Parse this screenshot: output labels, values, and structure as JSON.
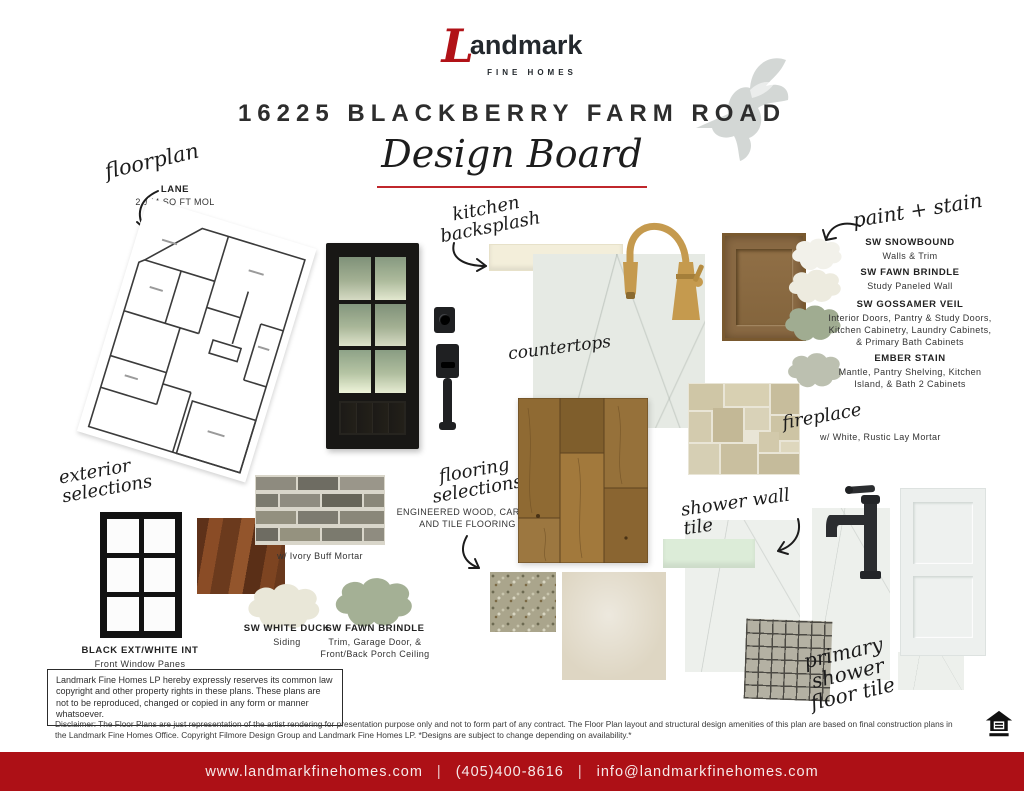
{
  "accent_red": "#b11217",
  "header": {
    "brand_initial": "L",
    "brand_rest": "andmark",
    "brand_sub": "FINE HOMES",
    "title": "16225 BLACKBERRY FARM ROAD",
    "subtitle": "Design Board"
  },
  "floorplan": {
    "label": "floorplan",
    "plan_name": "LANE",
    "plan_size": "2,144 SQ FT MOL"
  },
  "kitchen_backsplash": {
    "label": "kitchen backsplash"
  },
  "countertops": {
    "label": "countertops"
  },
  "paint_stain": {
    "label": "paint + stain",
    "items": [
      {
        "name": "SW SNOWBOUND",
        "desc": "Walls & Trim",
        "color": "#f2f1ea"
      },
      {
        "name": "SW FAWN BRINDLE",
        "desc": "Study Paneled Wall",
        "color": "#edebdf"
      },
      {
        "name": "SW GOSSAMER VEIL",
        "desc": "Interior Doors, Pantry & Study Doors, Kitchen Cabinetry, Laundry Cabinets, & Primary Bath Cabinets",
        "color": "#a0ac91"
      },
      {
        "name": "EMBER STAIN",
        "desc": "Mantle, Pantry Shelving, Kitchen Island, & Bath 2 Cabinets",
        "color": "#bcc0b0"
      }
    ]
  },
  "fireplace": {
    "label": "fireplace",
    "desc": "w/ White, Rustic Lay Mortar"
  },
  "exterior": {
    "label": "exterior selections",
    "window_name": "BLACK EXT/WHITE INT",
    "window_desc": "Front Window Panes",
    "brick_desc": "w/ Ivory Buff Mortar",
    "paints": [
      {
        "name": "SW WHITE DUCK",
        "desc": "Siding",
        "color": "#e9e7d8"
      },
      {
        "name": "SW FAWN BRINDLE",
        "desc": "Trim, Garage Door, & Front/Back Porch Ceiling",
        "color": "#a4b095"
      }
    ]
  },
  "flooring": {
    "label": "flooring selections",
    "desc": "ENGINEERED WOOD, CARPET AND TILE FLOORING"
  },
  "shower_wall": {
    "label": "shower wall tile"
  },
  "shower_floor": {
    "label": "primary shower floor tile"
  },
  "legal": {
    "copyright_box": "Landmark Fine Homes LP hereby expressly reserves its common law copyright and other property rights in these plans. These plans are not to be reproduced, changed or copied in any form or manner whatsoever.",
    "disclaimer": "Disclaimer: The Floor Plans are just representation of the artist rendering for presentation purpose only and not to form part of any contract. The Floor Plan layout and structural design amenities of this plan are based on final construction plans in the Landmark Fine Homes Office. Copyright Filmore Design Group and Landmark Fine Homes LP. *Designs are subject to change depending on availability.*"
  },
  "footer": {
    "website": "www.landmarkfinehomes.com",
    "phone": "(405)400-8616",
    "email": "info@landmarkfinehomes.com",
    "separator": "|"
  }
}
